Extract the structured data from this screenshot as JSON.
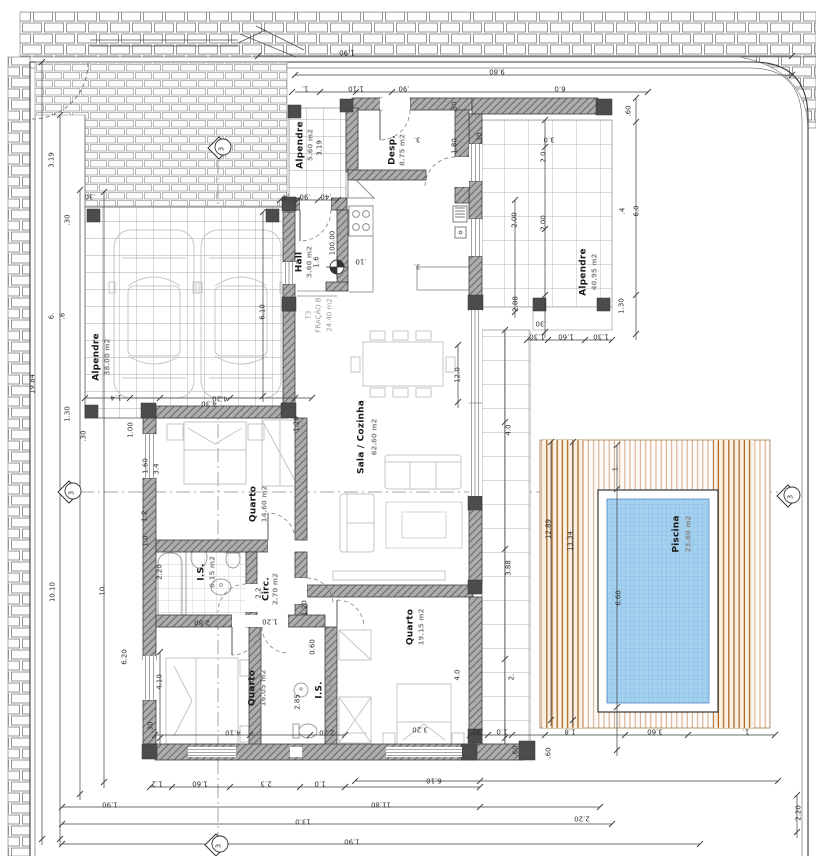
{
  "drawing": {
    "kind": "architectural floor plan",
    "language": "Portuguese"
  },
  "colors": {
    "wall_fill": "#adadad",
    "wall_hatch": "#666666",
    "post": "#4c4c4c",
    "pool_water": "#a5d1f0",
    "pool_grid": "#7fb4dc",
    "deck_line_light": "#d4a789",
    "deck_line_dark": "#b06a25",
    "tile_line": "#b5b5b5",
    "paving_line": "#8a8a8a",
    "dimension": "#3d3d3d",
    "furniture": "#bdbdbd"
  },
  "unit": {
    "type_label": "T3",
    "fraction_label": "FRAÇÃO B",
    "fraction_area": "24.40 m2"
  },
  "level": {
    "value": "100.00"
  },
  "rooms": [
    {
      "label": "Alpendre",
      "area": "38.00 m2",
      "x": 97,
      "y": 357,
      "ax": 108,
      "ay": 357
    },
    {
      "label": "Alpendre",
      "area": "5.60 m2",
      "x": 301,
      "y": 145,
      "ax": 311,
      "ay": 145
    },
    {
      "label": "Desp.",
      "area": "8.75 m2",
      "x": 393,
      "y": 150,
      "ax": 403,
      "ay": 150
    },
    {
      "label": "Hall",
      "area": "3.60 m2",
      "x": 300,
      "y": 262,
      "ax": 310,
      "ay": 262
    },
    {
      "label": "Sala / Cozinha",
      "area": "62.60 m2",
      "x": 362,
      "y": 437,
      "ax": 375,
      "ay": 437
    },
    {
      "label": "Quarto",
      "area": "14.60 m2",
      "x": 254,
      "y": 504,
      "ax": 265,
      "ay": 504
    },
    {
      "label": "I.S.",
      "area": "6.15 m2",
      "x": 202,
      "y": 572,
      "ax": 213,
      "ay": 572
    },
    {
      "label": "Circ.",
      "area": "2.70 m2",
      "x": 267,
      "y": 589,
      "ax": 276,
      "ay": 589
    },
    {
      "label": "Quarto",
      "area": "16.05 m2",
      "x": 253,
      "y": 688,
      "ax": 264,
      "ay": 688
    },
    {
      "label": "I.S.",
      "area": "6.15 m2",
      "x": 320,
      "y": 690,
      "ax": 330,
      "ay": 690
    },
    {
      "label": "Quarto",
      "area": "19.15 m2",
      "x": 411,
      "y": 627,
      "ax": 422,
      "ay": 627
    },
    {
      "label": "Alpendre",
      "area": "40.95 m2",
      "x": 584,
      "y": 272,
      "ax": 595,
      "ay": 272
    },
    {
      "label": "Piscina",
      "area": "23.60 m2",
      "x": 677,
      "y": 534,
      "ax": 689,
      "ay": 534
    }
  ],
  "annotations": [
    {
      "t": "1.90",
      "x": 347,
      "y": 52,
      "r": 180,
      "c": "d"
    },
    {
      "t": "9.80",
      "x": 497,
      "y": 71,
      "r": 180,
      "c": "d"
    },
    {
      "t": "1.",
      "x": 305,
      "y": 88,
      "r": 180,
      "c": "d"
    },
    {
      "t": "1.10",
      "x": 356,
      "y": 88,
      "r": 180,
      "c": "d"
    },
    {
      "t": ".90",
      "x": 404,
      "y": 88,
      "r": 180,
      "c": "d"
    },
    {
      "t": "6.0",
      "x": 560,
      "y": 88,
      "r": 180,
      "c": "d"
    },
    {
      "t": ".60",
      "x": 629,
      "y": 111,
      "r": -90,
      "c": "d"
    },
    {
      "t": "3.0",
      "x": 549,
      "y": 139,
      "r": 180,
      "c": "d"
    },
    {
      "t": "2.0",
      "x": 544,
      "y": 157,
      "r": -90,
      "c": "d"
    },
    {
      "t": "2.00",
      "x": 544,
      "y": 223,
      "r": -90,
      "c": "d"
    },
    {
      "t": ".4",
      "x": 623,
      "y": 211,
      "r": -90,
      "c": "d"
    },
    {
      "t": "6.0",
      "x": 637,
      "y": 211,
      "r": -90,
      "c": "d"
    },
    {
      "t": "2.88",
      "x": 516,
      "y": 304,
      "r": -90,
      "c": "d"
    },
    {
      "t": "2.00",
      "x": 515,
      "y": 220,
      "r": -90,
      "c": "d"
    },
    {
      "t": ".30",
      "x": 480,
      "y": 138,
      "r": -90,
      "c": "d"
    },
    {
      "t": ".30",
      "x": 455,
      "y": 107,
      "r": -90,
      "c": "d"
    },
    {
      "t": "1.80",
      "x": 455,
      "y": 146,
      "r": -90,
      "c": "d"
    },
    {
      "t": "1.30",
      "x": 622,
      "y": 306,
      "r": -90,
      "c": "d"
    },
    {
      "t": ".30",
      "x": 541,
      "y": 323,
      "r": 180,
      "c": "d"
    },
    {
      "t": "1.30",
      "x": 537,
      "y": 336,
      "r": 180,
      "c": "d"
    },
    {
      "t": "1.60",
      "x": 566,
      "y": 336,
      "r": 180,
      "c": "d"
    },
    {
      "t": "1.30",
      "x": 601,
      "y": 336,
      "r": 180,
      "c": "d"
    },
    {
      "t": "12.89",
      "x": 549,
      "y": 529,
      "r": -90,
      "c": "d"
    },
    {
      "t": "13.34",
      "x": 571,
      "y": 541,
      "r": -90,
      "c": "d"
    },
    {
      "t": "1.",
      "x": 616,
      "y": 468,
      "r": -90,
      "c": "d"
    },
    {
      "t": "6.60",
      "x": 619,
      "y": 598,
      "r": -90,
      "c": "d"
    },
    {
      "t": ".30",
      "x": 478,
      "y": 731,
      "r": 180,
      "c": "d"
    },
    {
      "t": "1.0",
      "x": 502,
      "y": 731,
      "r": 180,
      "c": "d"
    },
    {
      "t": "1.8",
      "x": 570,
      "y": 731,
      "r": 180,
      "c": "d"
    },
    {
      "t": "3.60",
      "x": 655,
      "y": 731,
      "r": 180,
      "c": "d"
    },
    {
      "t": "1.",
      "x": 746,
      "y": 731,
      "r": 180,
      "c": "d"
    },
    {
      "t": ".60",
      "x": 516,
      "y": 751,
      "r": -90,
      "c": "d"
    },
    {
      "t": ".60",
      "x": 549,
      "y": 753,
      "r": -90,
      "c": "d"
    },
    {
      "t": "6.10",
      "x": 434,
      "y": 780,
      "r": 180,
      "c": "d"
    },
    {
      "t": "2.20",
      "x": 582,
      "y": 818,
      "r": 180,
      "c": "d"
    },
    {
      "t": "2.20",
      "x": 799,
      "y": 813,
      "r": -90,
      "c": "d"
    },
    {
      "t": "1.2",
      "x": 157,
      "y": 783,
      "r": 180,
      "c": "d"
    },
    {
      "t": "1.60",
      "x": 200,
      "y": 783,
      "r": 180,
      "c": "d"
    },
    {
      "t": "2.3",
      "x": 266,
      "y": 783,
      "r": 180,
      "c": "d"
    },
    {
      "t": "1.0",
      "x": 320,
      "y": 783,
      "r": 180,
      "c": "d"
    },
    {
      "t": "1.90",
      "x": 110,
      "y": 804,
      "r": 180,
      "c": "d"
    },
    {
      "t": "11.80",
      "x": 381,
      "y": 804,
      "r": 180,
      "c": "d"
    },
    {
      "t": "13.0",
      "x": 303,
      "y": 821,
      "r": 180,
      "c": "d"
    },
    {
      "t": "1.90",
      "x": 352,
      "y": 841,
      "r": 180,
      "c": "d"
    },
    {
      "t": "19.84",
      "x": 33,
      "y": 384,
      "r": -90,
      "c": "d"
    },
    {
      "t": "3.19",
      "x": 52,
      "y": 160,
      "r": -90,
      "c": "d"
    },
    {
      "t": ".30",
      "x": 68,
      "y": 220,
      "r": -90,
      "c": "d"
    },
    {
      "t": ".30",
      "x": 90,
      "y": 196,
      "r": 180,
      "c": "d"
    },
    {
      "t": "6.",
      "x": 52,
      "y": 316,
      "r": -90,
      "c": "d"
    },
    {
      "t": ".6",
      "x": 63,
      "y": 316,
      "r": -90,
      "c": "d"
    },
    {
      "t": "1.30",
      "x": 68,
      "y": 414,
      "r": -90,
      "c": "d"
    },
    {
      "t": ".30",
      "x": 84,
      "y": 436,
      "r": -90,
      "c": "d"
    },
    {
      "t": "1.4",
      "x": 116,
      "y": 397,
      "r": 180,
      "c": "d"
    },
    {
      "t": "1.00",
      "x": 131,
      "y": 430,
      "r": -90,
      "c": "d"
    },
    {
      "t": "1.60",
      "x": 146,
      "y": 466,
      "r": -90,
      "c": "d"
    },
    {
      "t": "3.4",
      "x": 157,
      "y": 469,
      "r": -90,
      "c": "d"
    },
    {
      "t": "1.2",
      "x": 145,
      "y": 516,
      "r": -90,
      "c": "d"
    },
    {
      "t": "1.0",
      "x": 146,
      "y": 541,
      "r": -90,
      "c": "d"
    },
    {
      "t": "10.10",
      "x": 53,
      "y": 592,
      "r": -90,
      "c": "d"
    },
    {
      "t": "10.",
      "x": 103,
      "y": 590,
      "r": -90,
      "c": "d"
    },
    {
      "t": "6.20",
      "x": 125,
      "y": 657,
      "r": -90,
      "c": "d"
    },
    {
      "t": "2.20",
      "x": 160,
      "y": 572,
      "r": -90,
      "c": "d"
    },
    {
      "t": "4.10",
      "x": 160,
      "y": 682,
      "r": -90,
      "c": "d"
    },
    {
      "t": ".30",
      "x": 151,
      "y": 727,
      "r": -90,
      "c": "d"
    },
    {
      "t": "4.20",
      "x": 220,
      "y": 398,
      "r": 180,
      "c": "d"
    },
    {
      "t": ".4",
      "x": 286,
      "y": 196,
      "r": 180,
      "c": "d"
    },
    {
      "t": ".90",
      "x": 305,
      "y": 196,
      "r": 180,
      "c": "d"
    },
    {
      "t": ".40",
      "x": 326,
      "y": 196,
      "r": 180,
      "c": "d"
    },
    {
      "t": "6.10",
      "x": 263,
      "y": 312,
      "r": -90,
      "c": "d"
    },
    {
      "t": "4.30",
      "x": 209,
      "y": 403,
      "r": 180,
      "c": "d"
    },
    {
      "t": "1.20",
      "x": 297,
      "y": 424,
      "r": -90,
      "c": "d"
    },
    {
      "t": "2.2",
      "x": 259,
      "y": 593,
      "r": -90,
      "c": "d"
    },
    {
      "t": "1.20",
      "x": 305,
      "y": 608,
      "r": -90,
      "c": "d"
    },
    {
      "t": "2.80",
      "x": 202,
      "y": 622,
      "r": 180,
      "c": "d"
    },
    {
      "t": "1.20",
      "x": 270,
      "y": 621,
      "r": 180,
      "c": "d"
    },
    {
      "t": "0.60",
      "x": 313,
      "y": 647,
      "r": -90,
      "c": "d"
    },
    {
      "t": "2.85",
      "x": 298,
      "y": 702,
      "r": -90,
      "c": "d"
    },
    {
      "t": "2.20",
      "x": 327,
      "y": 732,
      "r": 180,
      "c": "d"
    },
    {
      "t": "4.10",
      "x": 233,
      "y": 732,
      "r": 180,
      "c": "d"
    },
    {
      "t": "3.20",
      "x": 420,
      "y": 729,
      "r": 180,
      "c": "d"
    },
    {
      "t": "12.0",
      "x": 458,
      "y": 375,
      "r": -90,
      "c": "d"
    },
    {
      "t": "3.",
      "x": 417,
      "y": 139,
      "r": 180,
      "c": "d"
    },
    {
      "t": "3.",
      "x": 417,
      "y": 266,
      "r": 180,
      "c": "d"
    },
    {
      "t": "1.6",
      "x": 317,
      "y": 262,
      "r": -90,
      "c": "d"
    },
    {
      "t": ".10",
      "x": 361,
      "y": 261,
      "r": 180,
      "c": "d"
    },
    {
      "t": "4.0",
      "x": 509,
      "y": 430,
      "r": -90,
      "c": "d"
    },
    {
      "t": "3.88",
      "x": 509,
      "y": 568,
      "r": -90,
      "c": "d"
    },
    {
      "t": "2.",
      "x": 512,
      "y": 677,
      "r": -90,
      "c": "d"
    },
    {
      "t": "4.0",
      "x": 458,
      "y": 675,
      "r": -90,
      "c": "d"
    },
    {
      "t": "3.19",
      "x": 320,
      "y": 148,
      "r": -90,
      "c": "d"
    },
    {
      "t": "100.00",
      "x": 333,
      "y": 243,
      "r": -90,
      "c": "L"
    },
    {
      "t": "T3",
      "x": 309,
      "y": 315,
      "r": -90,
      "c": "s"
    },
    {
      "t": "FRAÇÃO B",
      "x": 319,
      "y": 315,
      "r": -90,
      "c": "s"
    },
    {
      "t": "24.40 m2",
      "x": 330,
      "y": 315,
      "r": -90,
      "c": "s"
    },
    {
      "t": "3",
      "x": 222,
      "y": 149,
      "r": -90,
      "c": "m"
    },
    {
      "t": "3",
      "x": 72,
      "y": 493,
      "r": -90,
      "c": "m"
    },
    {
      "t": "3",
      "x": 791,
      "y": 497,
      "r": -90,
      "c": "m"
    },
    {
      "t": "3",
      "x": 219,
      "y": 846,
      "r": -90,
      "c": "m"
    }
  ],
  "section_markers": [
    {
      "label": "3",
      "position": "top"
    },
    {
      "label": "3",
      "position": "left"
    },
    {
      "label": "3",
      "position": "right"
    },
    {
      "label": "3",
      "position": "bottom"
    }
  ]
}
